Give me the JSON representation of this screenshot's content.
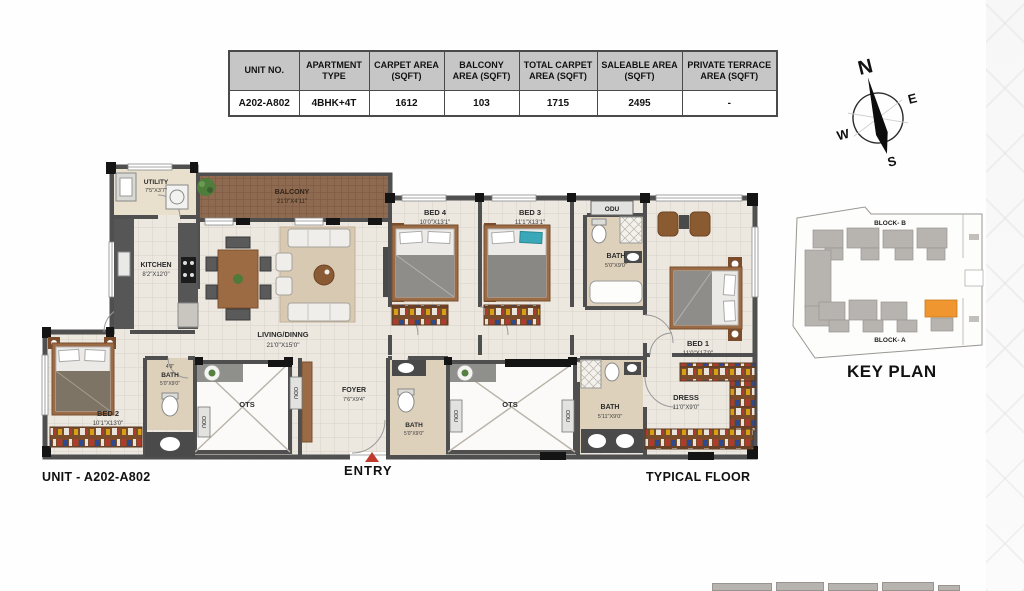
{
  "table": {
    "headers": [
      "UNIT NO.",
      "APARTMENT TYPE",
      "CARPET AREA (SQFT)",
      "BALCONY AREA (SQFT)",
      "TOTAL CARPET AREA (SQFT)",
      "SALEABLE AREA (SQFT)",
      "PRIVATE TERRACE AREA (SQFT)"
    ],
    "row": [
      "A202-A802",
      "4BHK+4T",
      "1612",
      "103",
      "1715",
      "2495",
      "-"
    ]
  },
  "compass": {
    "n": "N",
    "e": "E",
    "w": "W",
    "s": "S"
  },
  "plan": {
    "utility": {
      "name": "UTILITY",
      "dims": "7'5\"X3'7\""
    },
    "kitchen": {
      "name": "KITCHEN",
      "dims": "8'2\"X12'0\""
    },
    "balcony": {
      "name": "BALCONY",
      "dims": "21'0\"X4'11\""
    },
    "living": {
      "name": "LIVING/DINNG",
      "dims": "21'0\"X15'0\""
    },
    "bed4": {
      "name": "BED 4",
      "dims": "10'0\"X13'1\""
    },
    "bed3": {
      "name": "BED 3",
      "dims": "11'1\"X13'1\""
    },
    "bath_top": {
      "name": "BATH",
      "dims": "5'0\"X9'0\""
    },
    "bed1": {
      "name": "BED 1",
      "dims": "11'0\"X17'0\""
    },
    "bed2": {
      "name": "BED 2",
      "dims": "10'1\"X13'0\""
    },
    "bath_bed2": {
      "note": "4'9\"",
      "name": "BATH",
      "dims": "5'0\"X9'0\""
    },
    "bath_foyer": {
      "name": "BATH",
      "dims": "5'0\"X9'0\""
    },
    "bath_bed1": {
      "name": "BATH",
      "dims": "5'11\"X9'0\""
    },
    "foyer": {
      "name": "FOYER",
      "dims": "7'6\"X9'4\""
    },
    "dress": {
      "name": "DRESS",
      "dims": "11'0\"X9'0\""
    },
    "ots": "OTS",
    "odu": "ODU",
    "entry": "ENTRY"
  },
  "keyplan": {
    "title": "KEY PLAN",
    "block_b": "BLOCK- B",
    "block_a": "BLOCK- A"
  },
  "footer": {
    "unit": "UNIT - A202-A802",
    "floor": "TYPICAL FLOOR"
  },
  "colors": {
    "accent_orange": "#ef9630",
    "entry_red": "#c0392b",
    "balcony_brown": "#8d6a50",
    "wall_gray": "#4f4f4f",
    "table_header_bg": "#c6c6c6",
    "keyplan_gray": "#b7b3ae"
  }
}
